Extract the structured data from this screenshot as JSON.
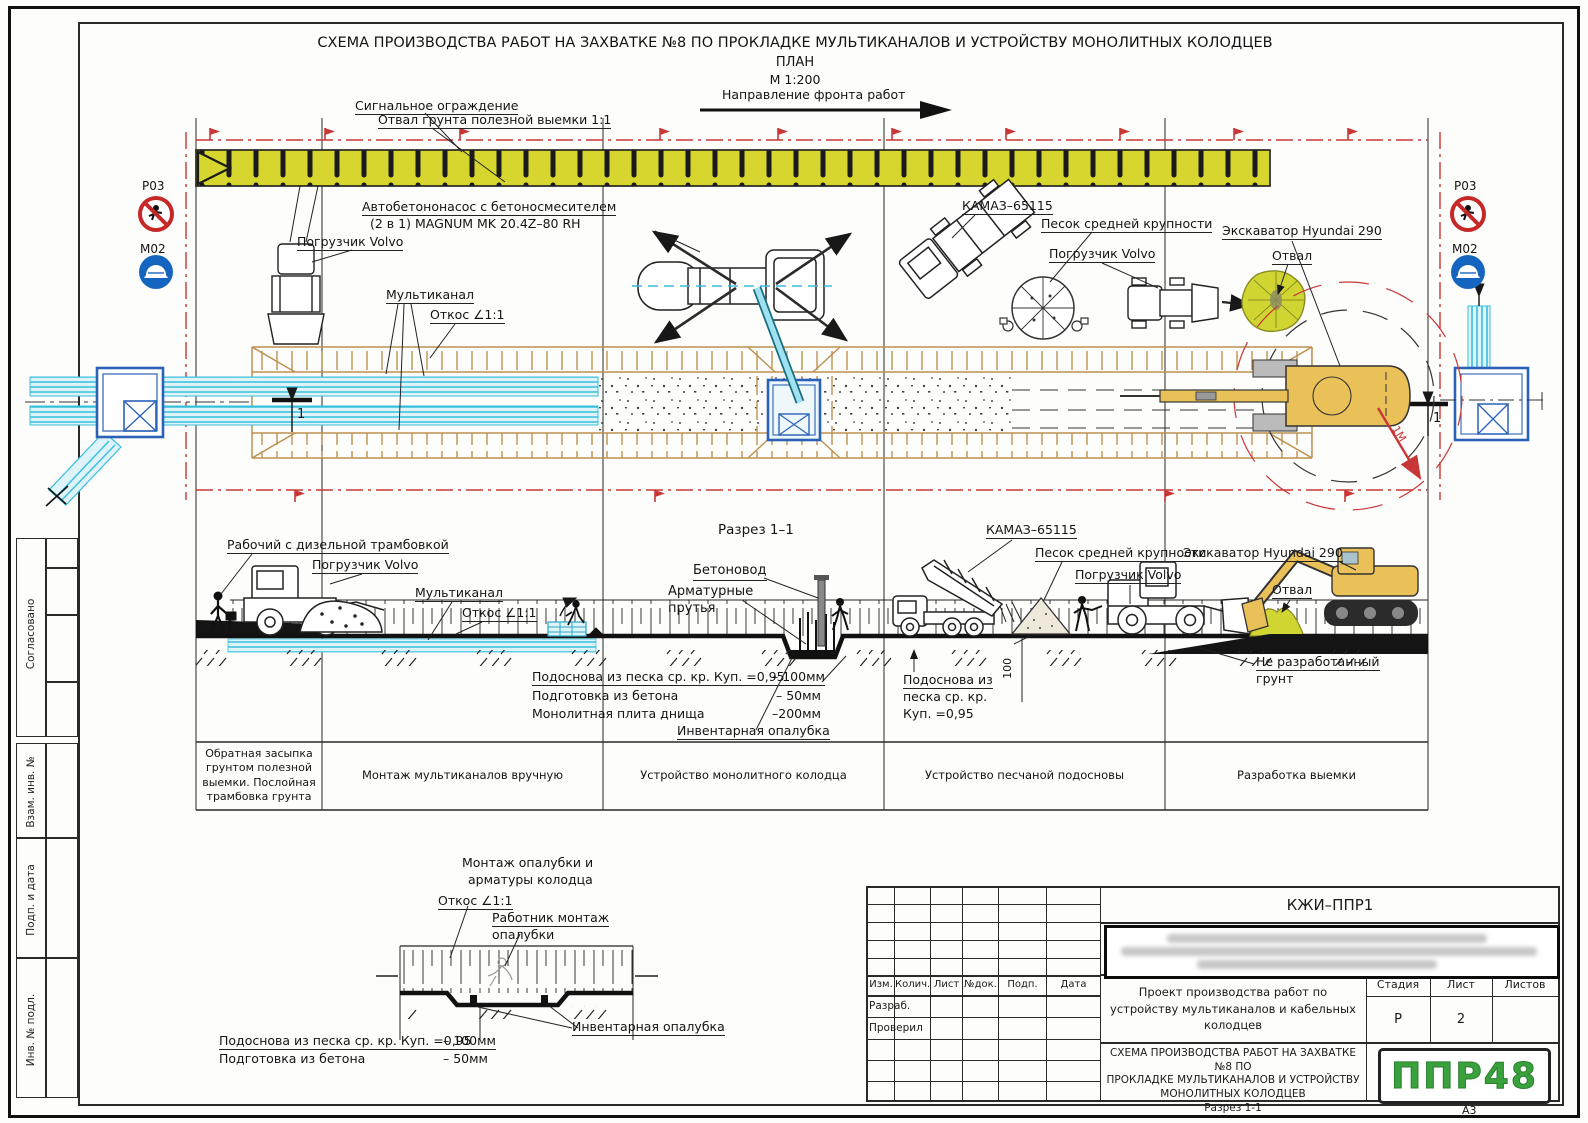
{
  "doc": {
    "title": "СХЕМА ПРОИЗВОДСТВА РАБОТ НА ЗАХВАТКЕ №8  ПО ПРОКЛАДКЕ МУЛЬТИКАНАЛОВ И УСТРОЙСТВУ МОНОЛИТНЫХ КОЛОДЦЕВ",
    "subtitle": "ПЛАН",
    "scale": "М 1:200",
    "direction": "Направление фронта работ",
    "format": "А3"
  },
  "plan": {
    "signal_fence": "Сигнальное ограждение",
    "spoil_bank": "Отвал грунта полезной выемки 1:1",
    "pump_line1": "Автобетононасос с бетоносмесителем",
    "pump_line2": "(2 в 1) MAGNUM MK 20.4Z–80 RH",
    "loader": "Погрузчик Volvo",
    "multichannel": "Мультиканал",
    "slope": "Откос ∠1:1",
    "kamaz": "КАМАЗ–65115",
    "sand": "Песок средней крупности",
    "excavator": "Экскаватор Hyundai 290",
    "spoil": "Отвал",
    "section_mark": "1",
    "radius_note": "1М"
  },
  "signs": {
    "p03": "Р03",
    "m02": "М02"
  },
  "section": {
    "title": "Разрез 1–1",
    "worker_rammer": "Рабочий с дизельной трамбовкой",
    "concrete_pipe": "Бетоновод",
    "rebar_line1": "Арматурные",
    "rebar_line2": "прутья",
    "note1_label": "Подоснова из песка ср. кр. Куп. =0,95",
    "note1_value": "– 100мм",
    "note2_label": "Подготовка из бетона",
    "note2_value": "– 50мм",
    "note3_label": "Монолитная плита днища",
    "note3_value": "–200мм",
    "formwork": "Инвентарная опалубка",
    "unexcavated_line1": "Не разработанный",
    "unexcavated_line2": "грунт",
    "subbase_line1": "Подоснова из",
    "subbase_line2": "песка ср. кр.",
    "subbase_line3": "Куп. =0,95",
    "dim100": "100"
  },
  "stages": [
    "Обратная засыпка грунтом полезной выемки. Послойная трамбовка грунта",
    "Монтаж мультиканалов вручную",
    "Устройство монолитного колодца",
    "Устройство песчаной подосновы",
    "Разработка выемки"
  ],
  "detail": {
    "title_line1": "Монтаж опалубки и",
    "title_line2": "арматуры колодца",
    "slope": "Откос ∠1:1",
    "worker_line1": "Работник монтаж",
    "worker_line2": "опалубки",
    "formwork": "Инвентарная опалубка",
    "note1_label": "Подоснова из песка ср. кр. Куп. =0,95",
    "note1_value": "– 100мм",
    "note2_label": "Подготовка из бетона",
    "note2_value": "– 50мм"
  },
  "title_block": {
    "code": "КЖИ–ППР1",
    "columns": [
      "Изм.",
      "Колич.",
      "Лист",
      "№док.",
      "Подп.",
      "Дата"
    ],
    "row1": "Разраб.",
    "row2": "Проверил",
    "project": "Проект производства работ по устройству мультиканалов и кабельных колодцев",
    "stage_label": "Стадия",
    "sheet_label": "Лист",
    "sheets_label": "Листов",
    "stage_value": "Р",
    "sheet_value": "2",
    "scheme_line1": "СХЕМА ПРОИЗВОДСТВА РАБОТ НА ЗАХВАТКЕ №8 ПО",
    "scheme_line2": "ПРОКЛАДКЕ МУЛЬТИКАНАЛОВ И УСТРОЙСТВУ",
    "scheme_line3": "МОНОЛИТНЫХ КОЛОДЦЕВ",
    "scheme_line4": "Разрез 1-1",
    "logo": "ППР48"
  },
  "sidebar": {
    "agreed": "Согласовано",
    "vzam": "Взам. инв. №",
    "podp": "Подп. и дата",
    "inv": "Инв. № подл."
  },
  "colors": {
    "berm_yellow": "#d6d62f",
    "trench_tan": "#bd9150",
    "duct_cyan": "#38bedd",
    "well_blue": "#2b62b8",
    "marker_red": "#c93636",
    "excavator_yellow": "#eac158",
    "logo_green": "#3aa23c"
  }
}
